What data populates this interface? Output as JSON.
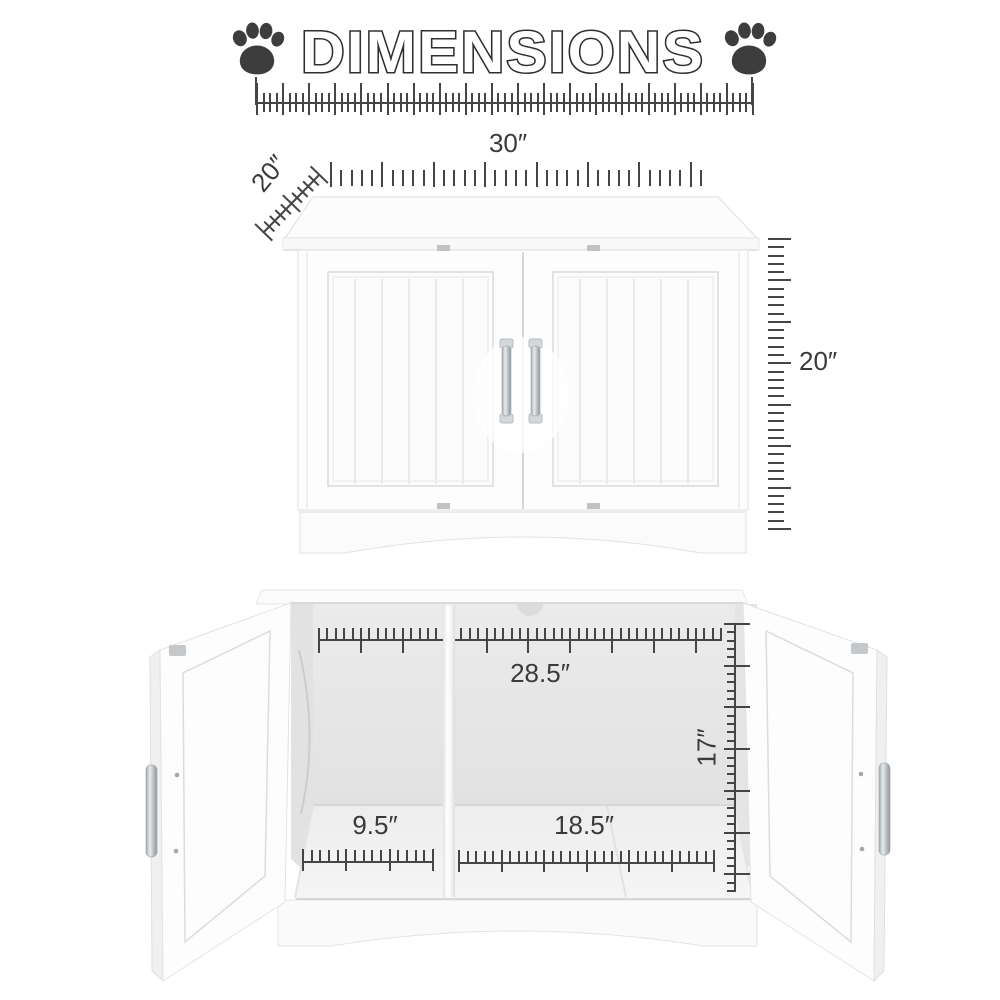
{
  "header": {
    "title": "DIMENSIONS"
  },
  "closed_view": {
    "width": "30″",
    "depth": "20″",
    "height": "20″"
  },
  "open_view": {
    "interior_width": "28.5″",
    "interior_height": "17″",
    "left_compartment": "9.5″",
    "right_compartment": "18.5″"
  },
  "icons": {
    "left": "paw-icon",
    "right": "paw-icon"
  },
  "colors": {
    "tick": "#454545",
    "label": "#3a3a3a",
    "paw": "#3d3d3d",
    "outline": "#2f2f2f"
  }
}
